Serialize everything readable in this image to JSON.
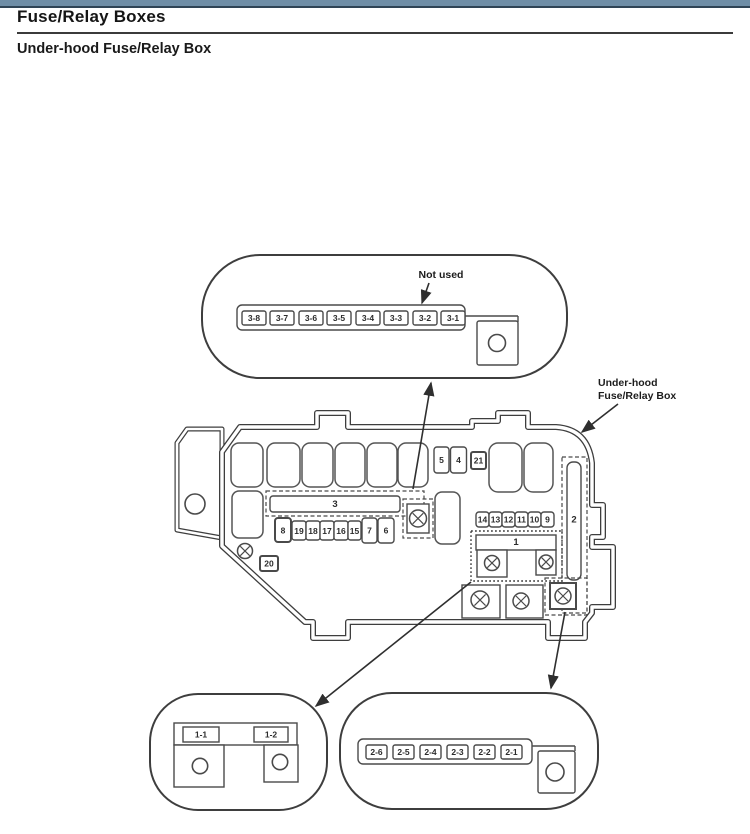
{
  "header": {
    "title": "Fuse/Relay Boxes",
    "subtitle": "Under-hood Fuse/Relay Box"
  },
  "diagram": {
    "annotations": {
      "not_used": "Not used",
      "box_label_line1": "Under-hood",
      "box_label_line2": "Fuse/Relay Box"
    },
    "top_oval": {
      "fuses": [
        "3-8",
        "3-7",
        "3-6",
        "3-5",
        "3-4",
        "3-3",
        "3-2",
        "3-1"
      ]
    },
    "main_box": {
      "small_fuses_top": [
        "5",
        "4",
        "21"
      ],
      "strip3_label": "3",
      "fuse_row": [
        "8",
        "19",
        "18",
        "17",
        "16",
        "15",
        "7",
        "6"
      ],
      "mid_fuse_row": [
        "14",
        "13",
        "12",
        "11",
        "10",
        "9"
      ],
      "block1_label": "1",
      "strip2_label": "2",
      "fuse20_label": "20"
    },
    "bottom_left_oval": {
      "fuses": [
        "1-1",
        "1-2"
      ]
    },
    "bottom_right_oval": {
      "fuses": [
        "2-6",
        "2-5",
        "2-4",
        "2-3",
        "2-2",
        "2-1"
      ]
    },
    "colors": {
      "line": "#3e3e3e",
      "top_bar": "#6f8ea7",
      "top_bar_border": "#2f4456"
    }
  }
}
